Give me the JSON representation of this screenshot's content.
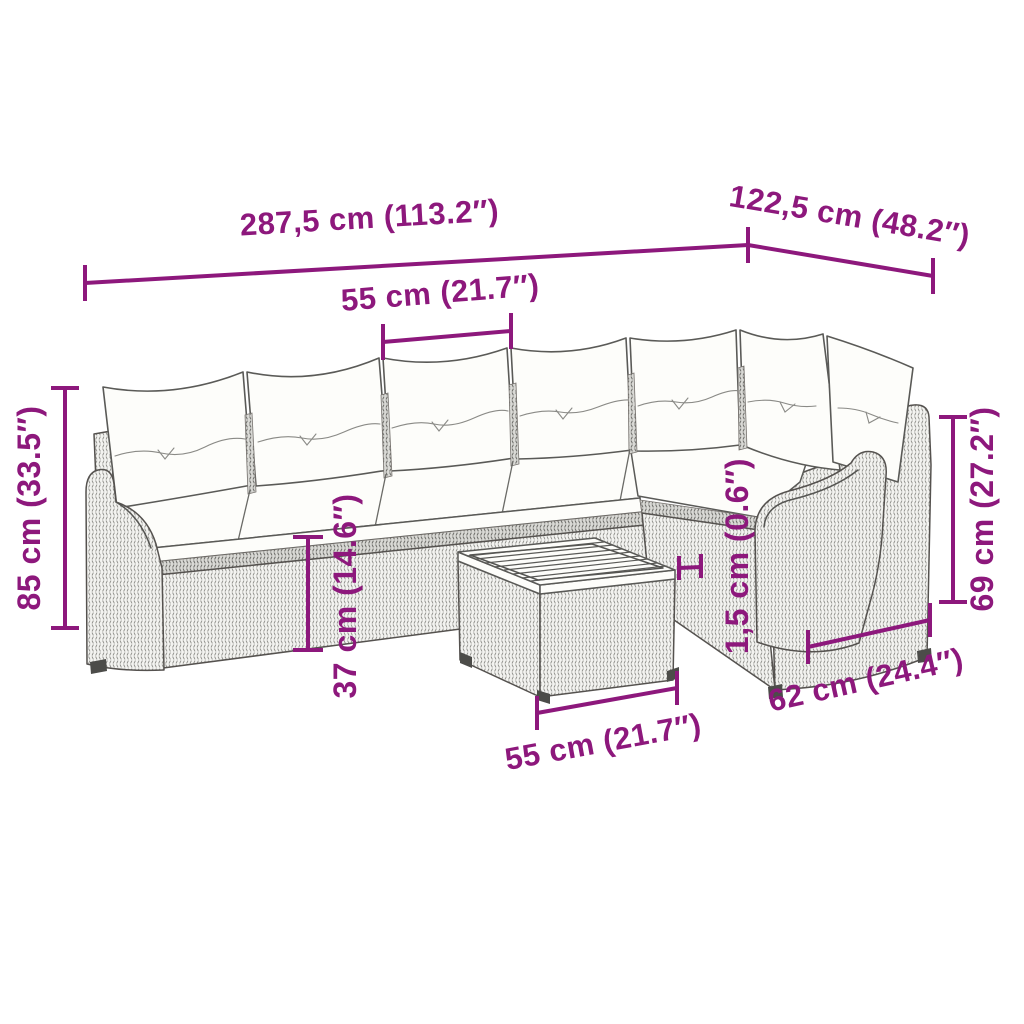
{
  "palette": {
    "dimension_accent": "#8D187C",
    "artwork_line": "#555552",
    "background": "#FFFFFF"
  },
  "diagram": {
    "kind": "product-dimension-diagram",
    "subject": "7-seat rattan corner lounge set with back and seat cushions and square slat-top table",
    "dims": {
      "total_length": "287,5 cm (113.2″)",
      "total_depth": "122,5 cm (48.2″)",
      "seat_module_width": "55 cm (21.7″)",
      "total_height": "85 cm (33.5″)",
      "back_height": "69 cm (27.2″)",
      "seat_height": "37 cm (14.6″)",
      "tabletop_thickness": "1,5 cm (0.6″)",
      "table_depth": "62 cm (24.4″)",
      "table_width": "55 cm (21.7″)"
    }
  }
}
